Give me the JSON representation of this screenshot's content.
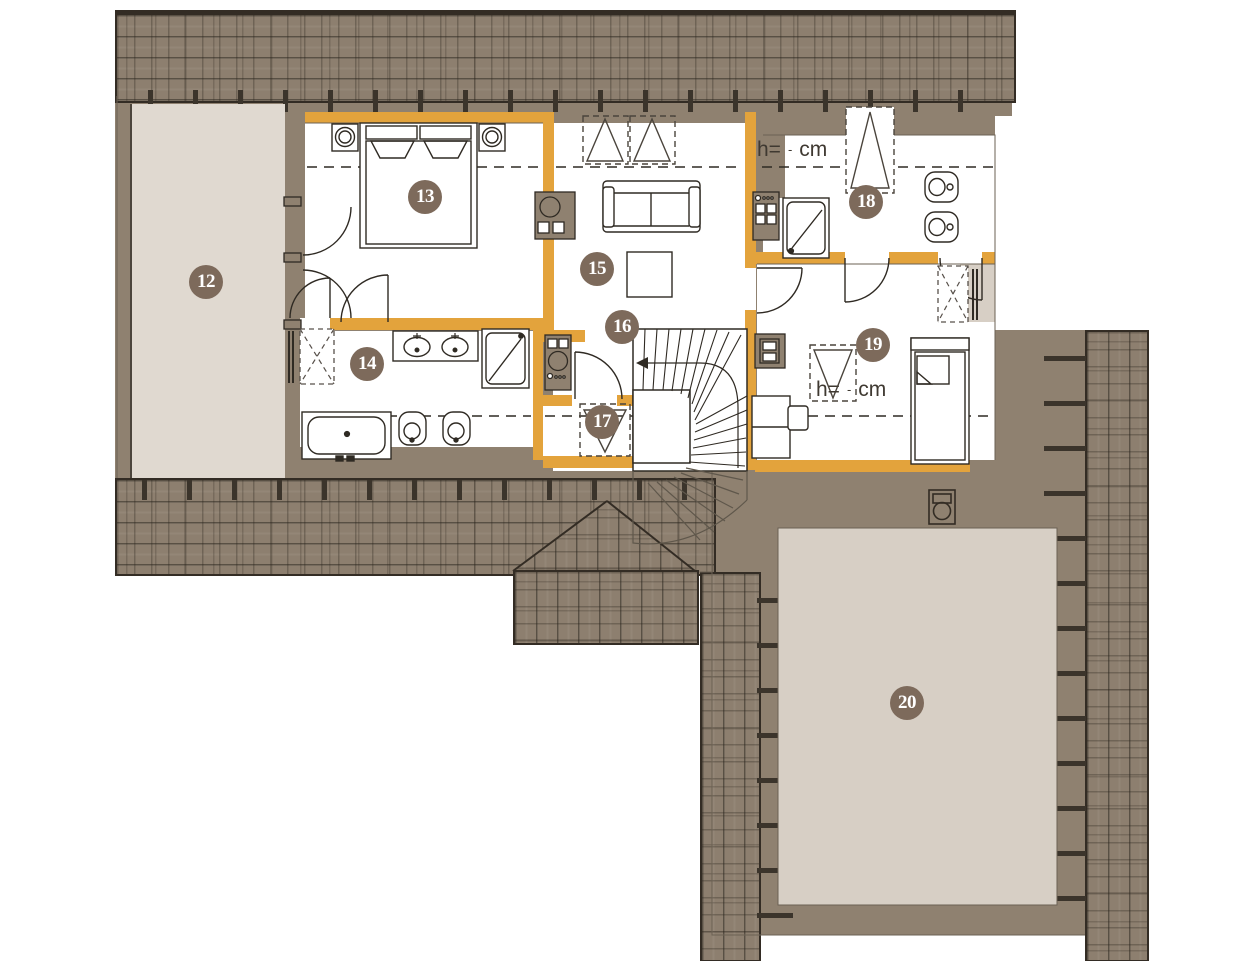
{
  "rooms": [
    {
      "id": 12,
      "label": "12"
    },
    {
      "id": 13,
      "label": "13"
    },
    {
      "id": 14,
      "label": "14"
    },
    {
      "id": 15,
      "label": "15"
    },
    {
      "id": 16,
      "label": "16"
    },
    {
      "id": 17,
      "label": "17"
    },
    {
      "id": 18,
      "label": "18"
    },
    {
      "id": 19,
      "label": "19"
    },
    {
      "id": 20,
      "label": "20"
    }
  ],
  "height_note": {
    "prefix": "h=",
    "placeholder": "-",
    "unit": "cm"
  },
  "colors": {
    "wall_accent": "#e3a33c",
    "poche": "#8f8170",
    "roof": "#8d7f6f",
    "terrace_upper": "#e0d9d0",
    "terrace_lower": "#d7cfc5",
    "badge": "#7d6a5b",
    "linework": "#2f2a23"
  }
}
